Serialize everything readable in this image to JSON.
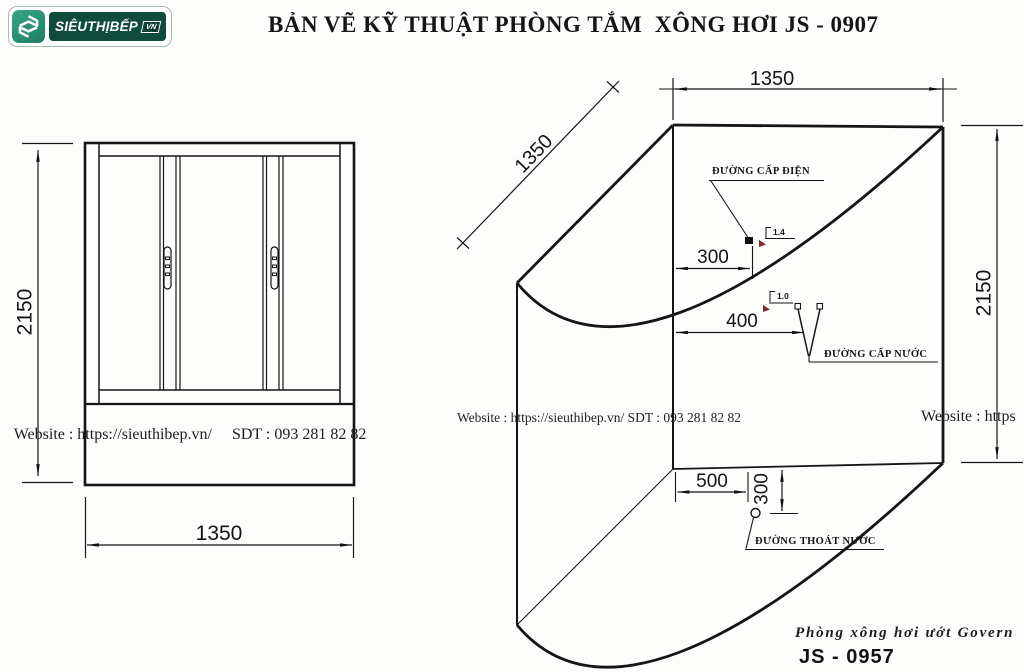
{
  "header": {
    "title": "BẢN VẼ KỸ THUẬT PHÒNG TẮM  XÔNG HƠI JS - 0907",
    "logo": {
      "brand": "SIÊUTHỊBẾP",
      "tag": "VN",
      "icon": "sieuthibep-hex-s",
      "colors": {
        "icon_green": "#2E9B7C",
        "panel_green": "#0F4C3C"
      }
    }
  },
  "watermarks": {
    "left_site": "Website : https://sieuthibep.vn/",
    "left_phone": "SDT : 093 281 82 82",
    "center": "Website : https://sieuthibep.vn/ SDT : 093 281 82 82",
    "right": "Website : https"
  },
  "front_view": {
    "height_mm": "2150",
    "width_mm": "1350"
  },
  "iso_view": {
    "width_mm": "1350",
    "depth_mm": "1350",
    "height_mm": "2150",
    "electric": {
      "label": "ĐƯỜNG CẤP ĐIỆN",
      "offset_mm": "300",
      "note": "1.4"
    },
    "water": {
      "label": "ĐƯỜNG CẤP NƯỚC",
      "offset_mm": "400",
      "note": "1.0"
    },
    "drain": {
      "label": "ĐƯỜNG THOÁT NƯỚC",
      "offset_x_mm": "500",
      "offset_y_mm": "300"
    }
  },
  "footer": {
    "product_line": "Phòng xông hơi ướt Govern",
    "model": "JS - 0957"
  },
  "colors": {
    "line": "#1a1a1a",
    "note_accent": "#7b2b25",
    "background": "#fdfdfc"
  }
}
